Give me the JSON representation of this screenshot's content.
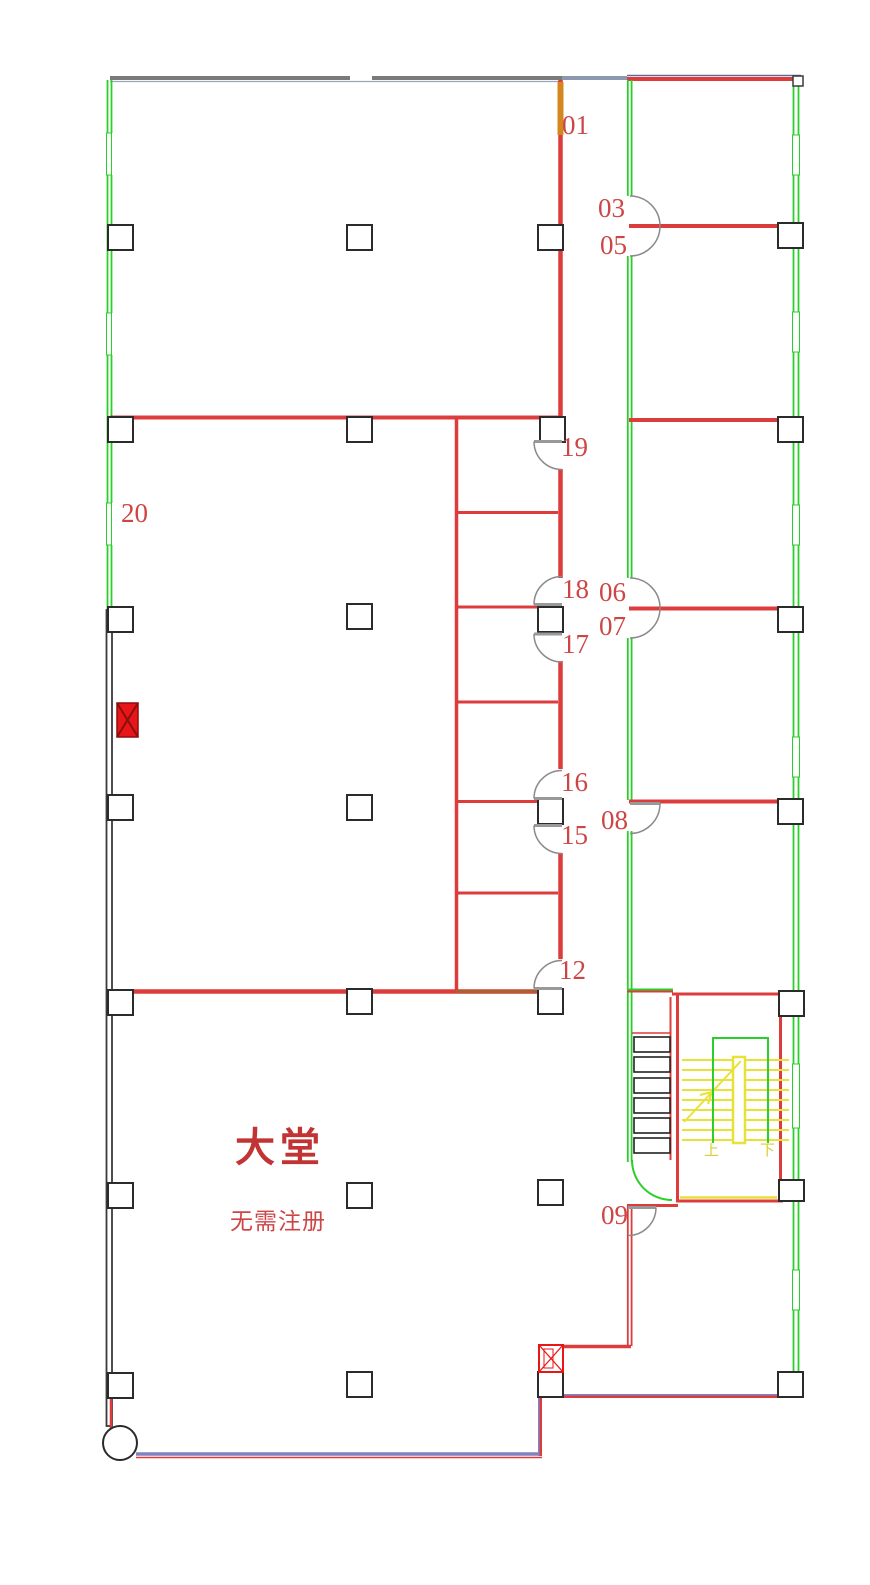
{
  "drawing_type": "architectural floor plan",
  "rooms": {
    "r01": "01",
    "r03": "03",
    "r05": "05",
    "r06": "06",
    "r07": "07",
    "r08": "08",
    "r09": "09",
    "r12": "12",
    "r15": "15",
    "r16": "16",
    "r17": "17",
    "r18": "18",
    "r19": "19",
    "r20": "20"
  },
  "lobby": {
    "title": "大堂",
    "subtitle": "无需注册"
  },
  "stairs": {
    "up": "上",
    "down": "下"
  },
  "colors": {
    "wall_red": "#dd3c3c",
    "window_green": "#2bcf2b",
    "stair_yellow": "#e8e138",
    "outline_black": "#2b2b2b",
    "wall_gray": "#7a7a7a",
    "base_blue": "#8282c0",
    "label_red": "#cd4646",
    "door_orange": "#d4871e",
    "hydrant_red": "#e81616",
    "lobby_text_red": "#c23333",
    "door_arc_gray": "#8a8a8a"
  }
}
